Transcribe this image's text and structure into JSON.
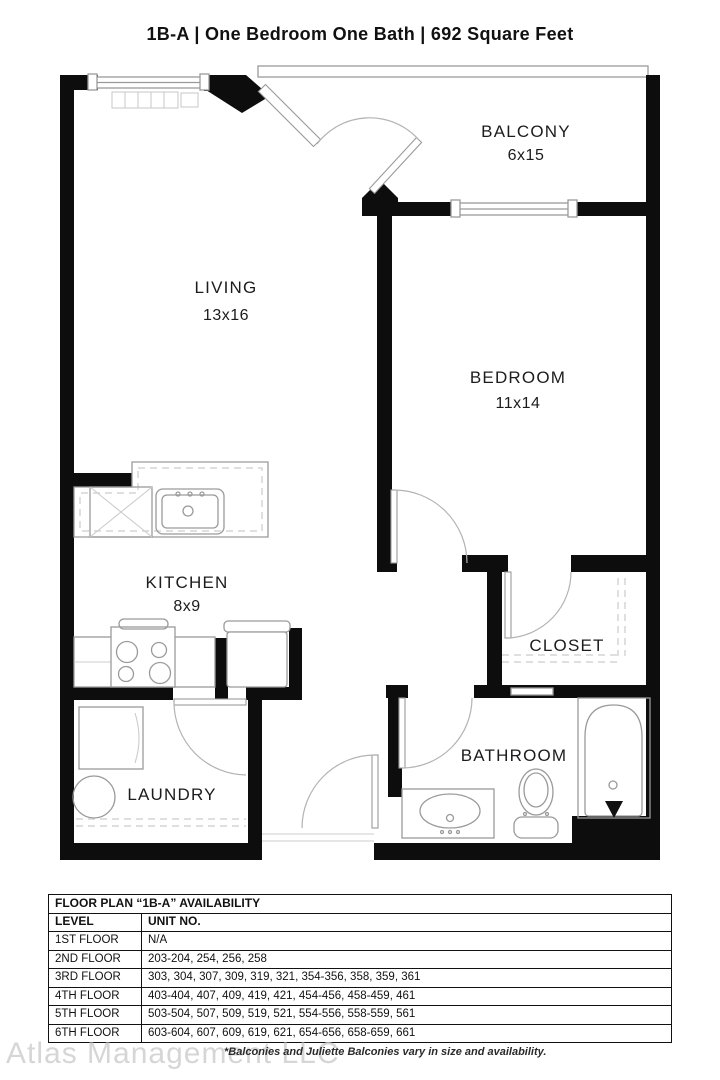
{
  "title": {
    "full": "1B-A | One Bedroom One Bath |  692 Square Feet"
  },
  "rooms": {
    "living": {
      "name": "LIVING",
      "dims": "13x16"
    },
    "balcony": {
      "name": "BALCONY",
      "dims": "6x15"
    },
    "bedroom": {
      "name": "BEDROOM",
      "dims": "11x14"
    },
    "kitchen": {
      "name": "KITCHEN",
      "dims": "8x9"
    },
    "closet": {
      "name": "CLOSET"
    },
    "laundry": {
      "name": "LAUNDRY"
    },
    "bathroom": {
      "name": "BATHROOM"
    }
  },
  "availability_table": {
    "title": "FLOOR PLAN “1B-A” AVAILABILITY",
    "columns": {
      "level": "LEVEL",
      "units": "UNIT NO."
    },
    "rows": [
      {
        "level": "1ST FLOOR",
        "units": "N/A"
      },
      {
        "level": "2ND FLOOR",
        "units": "203-204, 254, 256, 258"
      },
      {
        "level": "3RD FLOOR",
        "units": "303, 304, 307, 309, 319, 321, 354-356, 358, 359, 361"
      },
      {
        "level": "4TH FLOOR",
        "units": "403-404, 407, 409, 419, 421, 454-456, 458-459, 461"
      },
      {
        "level": "5TH FLOOR",
        "units": "503-504, 507, 509, 519, 521, 554-556, 558-559, 561"
      },
      {
        "level": "6TH FLOOR",
        "units": "603-604, 607, 609, 619, 621, 654-656, 658-659, 661"
      }
    ]
  },
  "footer": {
    "watermark": "Atlas Management LLC",
    "disclaimer": "*Balconies and Juliette Balconies vary in size and availability."
  },
  "colors": {
    "wall": "#0d0d0d",
    "line": "#9a9a9a",
    "lite": "#cccccc",
    "label": "#1c1c1e",
    "watermark": "#d6d6d6"
  }
}
